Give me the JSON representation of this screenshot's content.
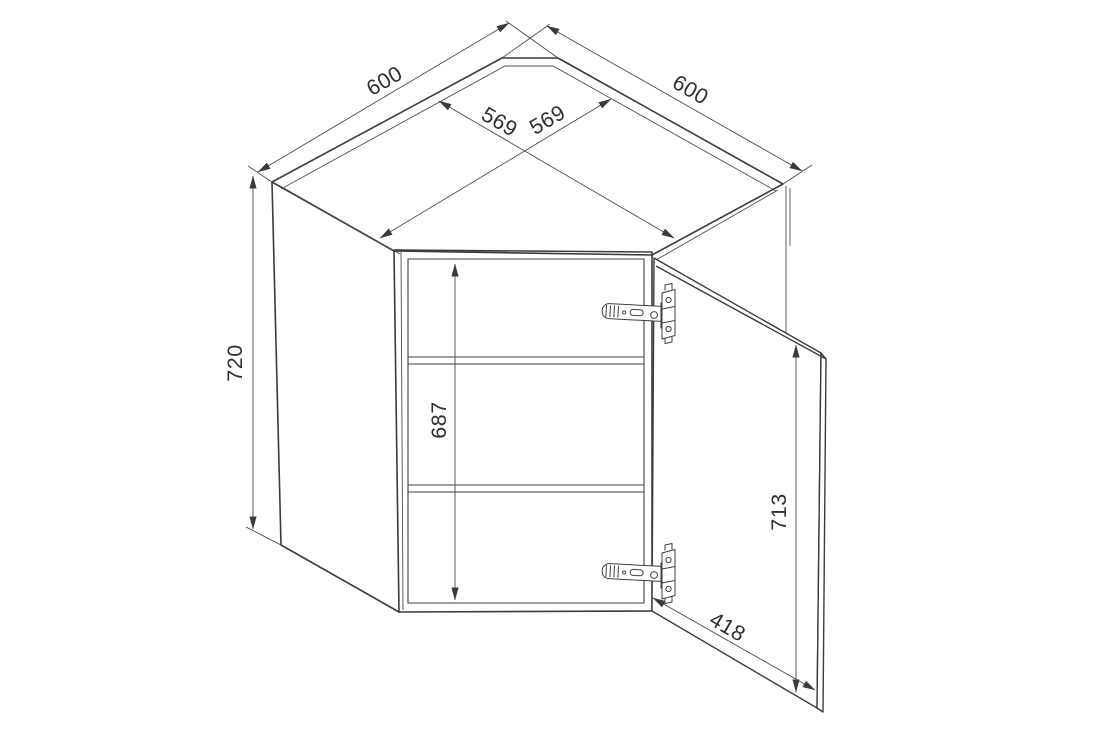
{
  "meta": {
    "description": "Technical line drawing of a diagonal corner wall cabinet with an open door, isometric view with dimension annotations",
    "drawing_type": "furniture-dimension-diagram"
  },
  "dimensions": {
    "back_left_width": "600",
    "back_right_width": "600",
    "inner_width_left": "569",
    "inner_width_right": "569",
    "cabinet_height": "720",
    "interior_height": "687",
    "door_height": "713",
    "door_width": "418"
  },
  "colors": {
    "background": "#ffffff",
    "outline": "#3c3c3c",
    "dimension_line": "#4a4a4a",
    "label_text": "#2f2f2f"
  }
}
